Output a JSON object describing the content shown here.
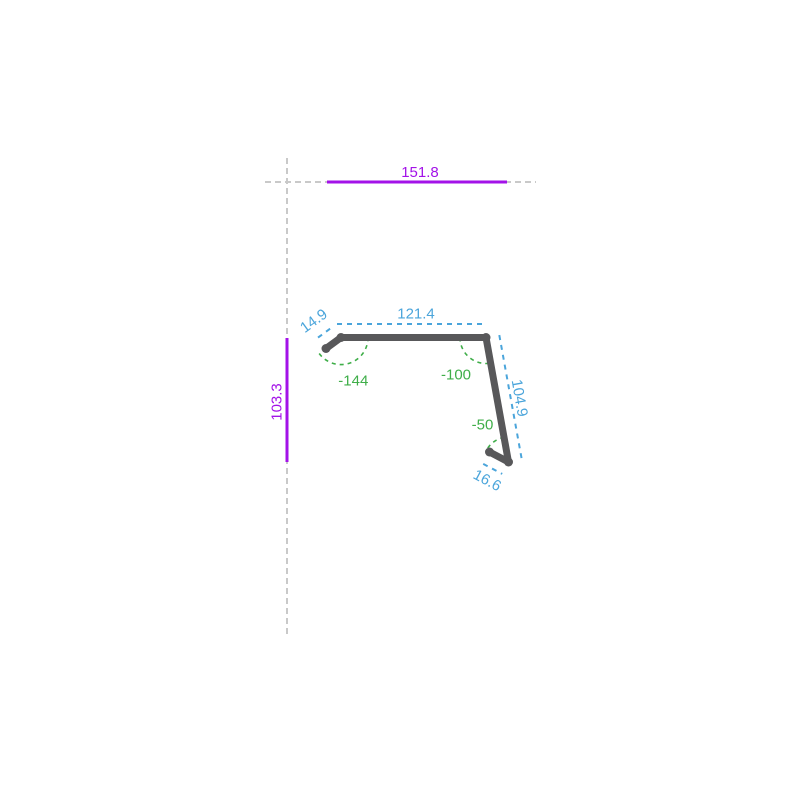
{
  "canvas": {
    "background": "#ffffff"
  },
  "colors": {
    "overall_dimension": "#a312e8",
    "segment_dimension": "#4ba5db",
    "angle": "#3fae49",
    "profile": "#58585a",
    "guide": "#c9c9c9"
  },
  "overall_dimensions": {
    "width": "151.8",
    "height": "103.3"
  },
  "segment_lengths": [
    {
      "label": "14.9"
    },
    {
      "label": "121.4"
    },
    {
      "label": "104.9"
    },
    {
      "label": "16.6"
    }
  ],
  "bend_angles": [
    {
      "label": "-144"
    },
    {
      "label": "-100"
    },
    {
      "label": "-50"
    }
  ]
}
